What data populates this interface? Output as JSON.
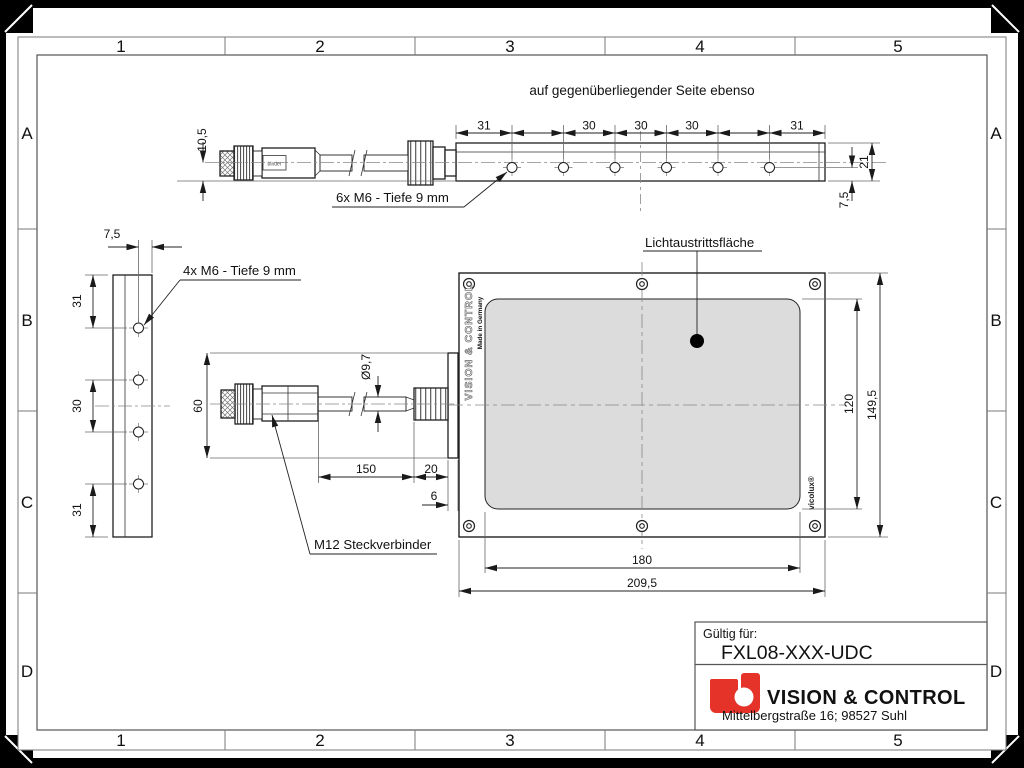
{
  "frame": {
    "cols": [
      "1",
      "2",
      "3",
      "4",
      "5"
    ],
    "rows": [
      "A",
      "B",
      "C",
      "D"
    ]
  },
  "labels": {
    "note": "auf gegenüberliegender Seite ebenso",
    "m6_top": "6x M6 - Tiefe 9 mm",
    "m6_side": "4x M6 - Tiefe 9 mm",
    "m12": "M12 Steckverbinder",
    "light": "Lichtaustrittsfläche"
  },
  "dims": {
    "top": {
      "pitch": [
        "31",
        "30",
        "30",
        "30",
        "31"
      ],
      "offset": "10,5",
      "height": "21",
      "edge": "7,5"
    },
    "side": {
      "width": "7,5",
      "v": [
        "31",
        "30",
        "31"
      ]
    },
    "conn": {
      "height": "60",
      "cable_dia": "Ø9,7",
      "cable_len": "150",
      "gland_len": "20",
      "lip": "6"
    },
    "front": {
      "h_active": "120",
      "h_total": "149,5",
      "w_active": "180",
      "w_total": "209,5"
    }
  },
  "branding": {
    "vertical": "VISION & CONTROL",
    "made_in": "Made in Germany",
    "vicolux": "vicolux®",
    "connector_tag": "binder"
  },
  "title_block": {
    "valid_label": "Gültig für:",
    "part": "FXL08-XXX-UDC",
    "company": "VISION & CONTROL",
    "address": "Mittelbergstraße 16; 98527 Suhl"
  },
  "colors": {
    "logo_red": "#e6332a",
    "surface_gray": "#dcdcdc",
    "line": "#1a1a1a"
  }
}
